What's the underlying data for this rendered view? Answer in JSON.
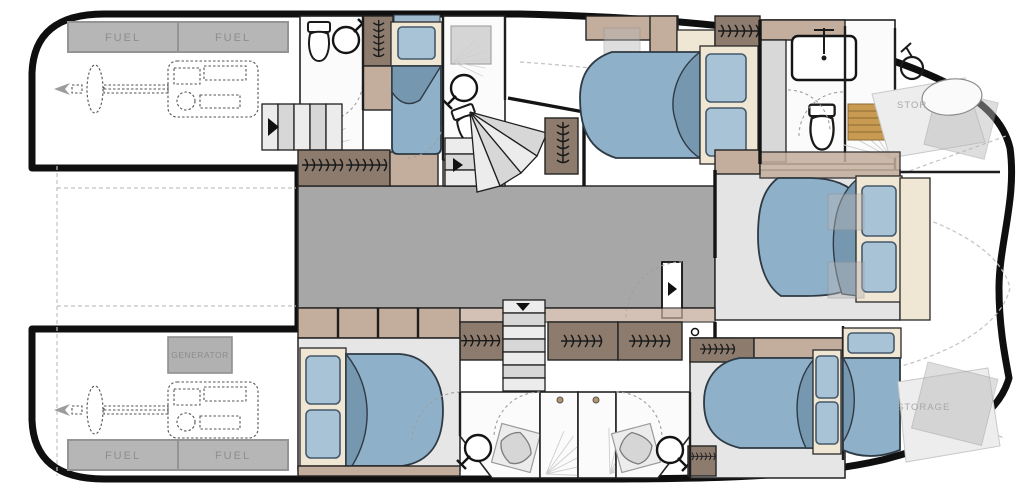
{
  "labels": {
    "port_engine_room": {
      "fuel_1": "FUEL",
      "fuel_2": "FUEL"
    },
    "starboard_engine_room": {
      "fuel_1": "FUEL",
      "fuel_2": "FUEL",
      "generator": "GENERATOR"
    },
    "port_bow": {
      "storage": "STOR"
    },
    "starboard_bow": {
      "storage": "STORAGE"
    }
  },
  "colors": {
    "outline_black": "#0f0f0f",
    "bed_blue": "#8fb0c9",
    "bed_fold": "#7697b0",
    "pillow_blue": "#a9c3d6",
    "cream": "#f0e6d4",
    "taupe_dark": "#8d7c6e",
    "taupe_mid": "#c3ad9c",
    "salon_gray": "#a7a7a7",
    "floor_light": "#e6e6e6",
    "wood": "#c99b52",
    "tank_gray": "#b6b6b6",
    "label_gray": "#8d8d8d"
  }
}
